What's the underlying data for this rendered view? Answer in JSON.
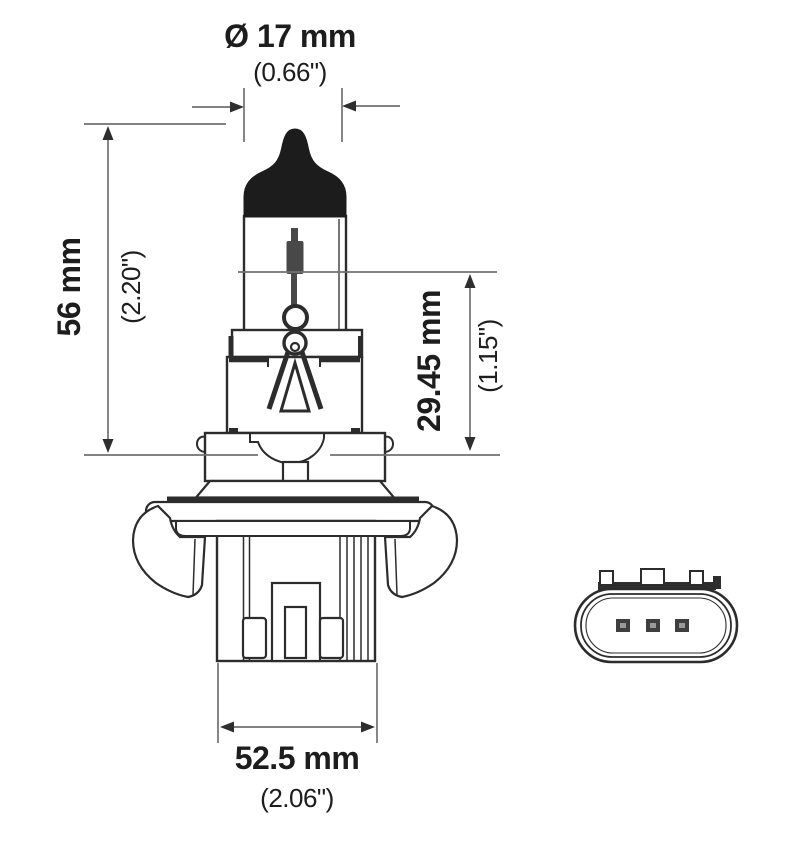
{
  "window": {
    "background": "#ffffff"
  },
  "diagram": {
    "subject": "Halogen headlight bulb technical drawing with base connector face view",
    "colors": {
      "outline": "#2c2c2c",
      "dimension_lines": "#717171",
      "text": "#1d1d1d",
      "bulb_tip_fill": "#1c1c1c",
      "background": "#ffffff"
    },
    "dims": {
      "diameter": {
        "metric": "Ø 17 mm",
        "imperial": "(0.66\")"
      },
      "overall_length": {
        "metric": "56 mm",
        "imperial": "(2.20\")"
      },
      "base_to_filament": {
        "metric": "29.45 mm",
        "imperial": "(1.15\")"
      },
      "base_width": {
        "metric": "52.5 mm",
        "imperial": "(2.06\")"
      }
    }
  }
}
